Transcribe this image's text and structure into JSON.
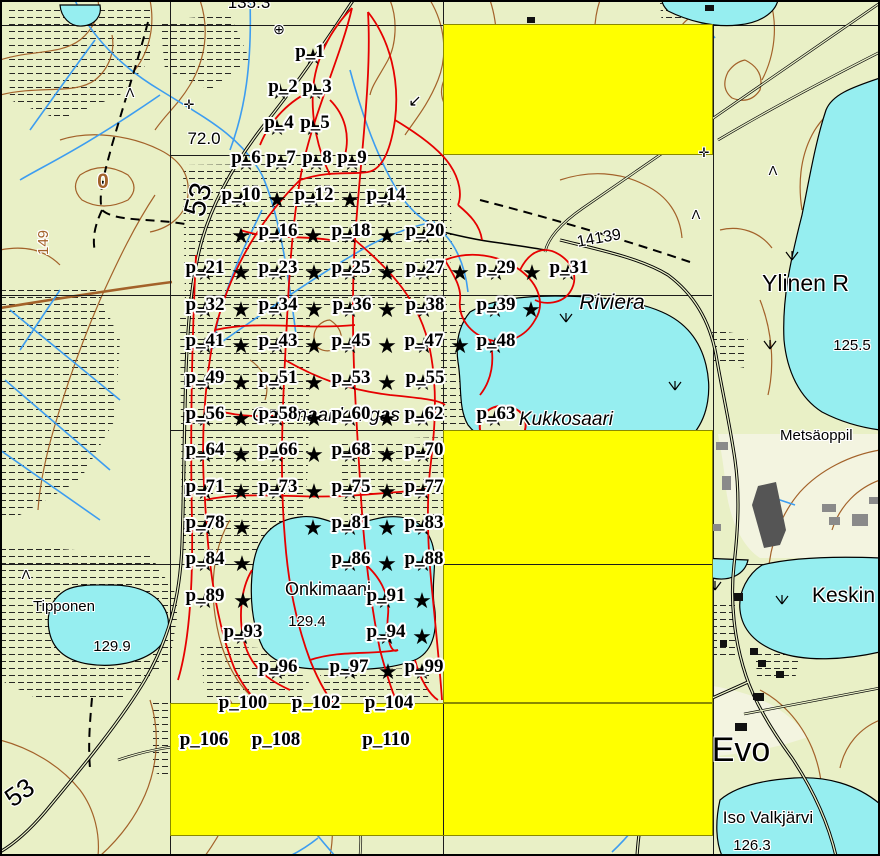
{
  "app": {
    "type": "map-canvas",
    "description": "Topographic map with sampling design points and highlighted grid cells"
  },
  "colors": {
    "land": "#e9f0c6",
    "open_land": "#f3f4e0",
    "water": "#96eef0",
    "highlight_yellow": "#ffff00",
    "highlight_border": "#8a8a00",
    "trail_red": "#e60000",
    "contour_brown": "#a3622a",
    "stream_blue": "#3d9df0",
    "grid_black": "#1c1c1c",
    "star_black": "#000000",
    "label_halo": "#ffffff"
  },
  "symbols": {
    "star": "★",
    "benchmark": "⊕",
    "powerline_cross": "✛",
    "slope_arrow": "↙",
    "tree": "Λ"
  },
  "highlight_rects": [
    {
      "x": 443,
      "y": 24,
      "w": 270,
      "h": 131
    },
    {
      "x": 443,
      "y": 430,
      "w": 270,
      "h": 273
    },
    {
      "x": 170,
      "y": 703,
      "w": 543,
      "h": 133
    }
  ],
  "grid_over_segments": [
    {
      "x": 443,
      "y": 704,
      "w": 1,
      "h": 131
    },
    {
      "x": 444,
      "y": 564,
      "w": 268,
      "h": 1
    }
  ],
  "sample_points": {
    "labels": [
      {
        "id": "p_1",
        "x": 310,
        "y": 42
      },
      {
        "id": "p_2",
        "x": 283,
        "y": 77
      },
      {
        "id": "p_3",
        "x": 317,
        "y": 77
      },
      {
        "id": "p_4",
        "x": 279,
        "y": 113
      },
      {
        "id": "p_5",
        "x": 315,
        "y": 113
      },
      {
        "id": "p_6",
        "x": 246,
        "y": 148
      },
      {
        "id": "p_7",
        "x": 281,
        "y": 148
      },
      {
        "id": "p_8",
        "x": 317,
        "y": 148
      },
      {
        "id": "p_9",
        "x": 352,
        "y": 148
      },
      {
        "id": "p_10",
        "x": 241,
        "y": 185
      },
      {
        "id": "p_12",
        "x": 314,
        "y": 185
      },
      {
        "id": "p_14",
        "x": 386,
        "y": 185
      },
      {
        "id": "p_16",
        "x": 278,
        "y": 221
      },
      {
        "id": "p_18",
        "x": 351,
        "y": 221
      },
      {
        "id": "p_20",
        "x": 425,
        "y": 221
      },
      {
        "id": "p_21",
        "x": 205,
        "y": 258
      },
      {
        "id": "p_23",
        "x": 278,
        "y": 258
      },
      {
        "id": "p_25",
        "x": 351,
        "y": 258
      },
      {
        "id": "p_27",
        "x": 425,
        "y": 258
      },
      {
        "id": "p_29",
        "x": 496,
        "y": 258
      },
      {
        "id": "p_31",
        "x": 569,
        "y": 258
      },
      {
        "id": "p_32",
        "x": 205,
        "y": 295
      },
      {
        "id": "p_34",
        "x": 278,
        "y": 295
      },
      {
        "id": "p_36",
        "x": 352,
        "y": 295
      },
      {
        "id": "p_38",
        "x": 425,
        "y": 295
      },
      {
        "id": "p_39",
        "x": 496,
        "y": 295
      },
      {
        "id": "p_41",
        "x": 205,
        "y": 331
      },
      {
        "id": "p_43",
        "x": 278,
        "y": 331
      },
      {
        "id": "p_45",
        "x": 351,
        "y": 331
      },
      {
        "id": "p_47",
        "x": 424,
        "y": 331
      },
      {
        "id": "p_48",
        "x": 496,
        "y": 331
      },
      {
        "id": "p_49",
        "x": 205,
        "y": 368
      },
      {
        "id": "p_51",
        "x": 278,
        "y": 368
      },
      {
        "id": "p_53",
        "x": 351,
        "y": 368
      },
      {
        "id": "p_55",
        "x": 425,
        "y": 368
      },
      {
        "id": "p_56",
        "x": 205,
        "y": 404
      },
      {
        "id": "p_58",
        "x": 278,
        "y": 404
      },
      {
        "id": "p_60",
        "x": 351,
        "y": 404
      },
      {
        "id": "p_62",
        "x": 424,
        "y": 404
      },
      {
        "id": "p_63",
        "x": 496,
        "y": 404
      },
      {
        "id": "p_64",
        "x": 205,
        "y": 440
      },
      {
        "id": "p_66",
        "x": 278,
        "y": 440
      },
      {
        "id": "p_68",
        "x": 351,
        "y": 440
      },
      {
        "id": "p_70",
        "x": 424,
        "y": 440
      },
      {
        "id": "p_71",
        "x": 205,
        "y": 477
      },
      {
        "id": "p_73",
        "x": 278,
        "y": 477
      },
      {
        "id": "p_75",
        "x": 351,
        "y": 477
      },
      {
        "id": "p_77",
        "x": 424,
        "y": 477
      },
      {
        "id": "p_78",
        "x": 205,
        "y": 513
      },
      {
        "id": "p_81",
        "x": 351,
        "y": 513
      },
      {
        "id": "p_83",
        "x": 424,
        "y": 513
      },
      {
        "id": "p_84",
        "x": 205,
        "y": 549
      },
      {
        "id": "p_86",
        "x": 351,
        "y": 549
      },
      {
        "id": "p_88",
        "x": 424,
        "y": 549
      },
      {
        "id": "p_89",
        "x": 205,
        "y": 586
      },
      {
        "id": "p_91",
        "x": 386,
        "y": 586
      },
      {
        "id": "p_93",
        "x": 243,
        "y": 622
      },
      {
        "id": "p_94",
        "x": 386,
        "y": 622
      },
      {
        "id": "p_96",
        "x": 278,
        "y": 657
      },
      {
        "id": "p_97",
        "x": 349,
        "y": 657
      },
      {
        "id": "p_99",
        "x": 424,
        "y": 657
      },
      {
        "id": "p_100",
        "x": 243,
        "y": 693
      },
      {
        "id": "p_102",
        "x": 316,
        "y": 693
      },
      {
        "id": "p_104",
        "x": 389,
        "y": 693
      },
      {
        "id": "p_106",
        "x": 204,
        "y": 730
      },
      {
        "id": "p_108",
        "x": 276,
        "y": 730
      },
      {
        "id": "p_110",
        "x": 386,
        "y": 730
      }
    ],
    "stars": [
      [
        313,
        58
      ],
      [
        280,
        93
      ],
      [
        315,
        93
      ],
      [
        277,
        129
      ],
      [
        313,
        129
      ],
      [
        246,
        164
      ],
      [
        281,
        164
      ],
      [
        316,
        164
      ],
      [
        352,
        164
      ],
      [
        241,
        201
      ],
      [
        277,
        201
      ],
      [
        313,
        201
      ],
      [
        350,
        201
      ],
      [
        386,
        201
      ],
      [
        241,
        237
      ],
      [
        277,
        237
      ],
      [
        313,
        237
      ],
      [
        350,
        237
      ],
      [
        387,
        237
      ],
      [
        424,
        237
      ],
      [
        205,
        274
      ],
      [
        241,
        274
      ],
      [
        277,
        274
      ],
      [
        314,
        274
      ],
      [
        350,
        274
      ],
      [
        387,
        274
      ],
      [
        424,
        274
      ],
      [
        460,
        274
      ],
      [
        496,
        274
      ],
      [
        532,
        274
      ],
      [
        568,
        274
      ],
      [
        205,
        311
      ],
      [
        241,
        311
      ],
      [
        277,
        311
      ],
      [
        314,
        311
      ],
      [
        350,
        311
      ],
      [
        387,
        311
      ],
      [
        424,
        311
      ],
      [
        495,
        311
      ],
      [
        531,
        311
      ],
      [
        205,
        347
      ],
      [
        241,
        347
      ],
      [
        277,
        347
      ],
      [
        314,
        347
      ],
      [
        350,
        347
      ],
      [
        387,
        347
      ],
      [
        424,
        347
      ],
      [
        460,
        347
      ],
      [
        495,
        347
      ],
      [
        205,
        384
      ],
      [
        241,
        384
      ],
      [
        277,
        384
      ],
      [
        314,
        384
      ],
      [
        350,
        384
      ],
      [
        387,
        384
      ],
      [
        423,
        384
      ],
      [
        205,
        420
      ],
      [
        241,
        420
      ],
      [
        277,
        420
      ],
      [
        314,
        420
      ],
      [
        350,
        420
      ],
      [
        387,
        420
      ],
      [
        423,
        420
      ],
      [
        495,
        420
      ],
      [
        205,
        456
      ],
      [
        241,
        456
      ],
      [
        277,
        456
      ],
      [
        314,
        456
      ],
      [
        350,
        456
      ],
      [
        387,
        456
      ],
      [
        423,
        456
      ],
      [
        205,
        493
      ],
      [
        241,
        493
      ],
      [
        277,
        493
      ],
      [
        314,
        493
      ],
      [
        350,
        493
      ],
      [
        387,
        493
      ],
      [
        423,
        493
      ],
      [
        205,
        529
      ],
      [
        242,
        529
      ],
      [
        313,
        529
      ],
      [
        350,
        529
      ],
      [
        387,
        529
      ],
      [
        423,
        529
      ],
      [
        205,
        565
      ],
      [
        242,
        565
      ],
      [
        350,
        565
      ],
      [
        387,
        565
      ],
      [
        423,
        565
      ],
      [
        205,
        602
      ],
      [
        243,
        602
      ],
      [
        385,
        602
      ],
      [
        422,
        602
      ],
      [
        242,
        638
      ],
      [
        387,
        638
      ],
      [
        422,
        638
      ],
      [
        277,
        673
      ],
      [
        350,
        673
      ],
      [
        388,
        673
      ],
      [
        422,
        673
      ]
    ]
  },
  "map_labels": [
    {
      "text": "135.3",
      "x": 249,
      "y": -6,
      "size": 17,
      "name": "spot-height-135-3"
    },
    {
      "text": "72.0",
      "x": 204,
      "y": 130,
      "size": 17,
      "name": "spot-height-72-0"
    },
    {
      "text": "0",
      "x": 103,
      "y": 171,
      "size": 21,
      "color": "#a3622a",
      "bold": true,
      "name": "contour-number-0"
    },
    {
      "text": "53",
      "x": 180,
      "y": 212,
      "size": 30,
      "rotate": -75,
      "anchor": "left",
      "name": "compartment-number-53"
    },
    {
      "text": "149",
      "x": 36,
      "y": 255,
      "size": 15,
      "color": "#a3622a",
      "rotate": -90,
      "anchor": "left",
      "name": "contour-number-149"
    },
    {
      "text": "14139",
      "x": 598,
      "y": 235,
      "size": 16,
      "rotate": -10,
      "name": "road-number-14139"
    },
    {
      "text": "Riviera",
      "x": 612,
      "y": 292,
      "size": 21,
      "italic": true,
      "name": "lake-name-riviera"
    },
    {
      "text": "Ylinen R",
      "x": 762,
      "y": 272,
      "size": 23,
      "anchor": "left",
      "name": "lake-name-ylinen"
    },
    {
      "text": "125.5",
      "x": 852,
      "y": 338,
      "size": 15,
      "name": "water-level-125-5"
    },
    {
      "text": "Kukkosaari",
      "x": 566,
      "y": 410,
      "size": 19,
      "italic": true,
      "name": "island-name-kukkosaari"
    },
    {
      "text": "Onkimaankangas",
      "x": 326,
      "y": 406,
      "size": 19,
      "italic": true,
      "name": "area-name-onkimaankangas"
    },
    {
      "text": "Metsäoppil",
      "x": 780,
      "y": 428,
      "size": 15,
      "anchor": "left",
      "name": "place-name-metsaoppilaitos"
    },
    {
      "text": "Onkimaanj",
      "x": 285,
      "y": 580,
      "size": 18,
      "anchor": "left",
      "name": "lake-name-onkimaanjarvi"
    },
    {
      "text": "129.4",
      "x": 307,
      "y": 614,
      "size": 15,
      "name": "water-level-129-4"
    },
    {
      "text": "Tipponen",
      "x": 64,
      "y": 599,
      "size": 15,
      "name": "pond-name-tipponen"
    },
    {
      "text": "129.9",
      "x": 112,
      "y": 639,
      "size": 15,
      "name": "water-level-129-9"
    },
    {
      "text": "Keskin",
      "x": 812,
      "y": 585,
      "size": 21,
      "anchor": "left",
      "name": "lake-name-keskinen"
    },
    {
      "text": "Evo",
      "x": 741,
      "y": 733,
      "size": 34,
      "name": "place-name-evo"
    },
    {
      "text": "Iso Valkjärvi",
      "x": 768,
      "y": 809,
      "size": 17,
      "name": "lake-name-iso-valkjarvi"
    },
    {
      "text": "126.3",
      "x": 752,
      "y": 838,
      "size": 15,
      "name": "water-level-126-3"
    },
    {
      "text": "53",
      "x": 0,
      "y": 790,
      "size": 26,
      "rotate": -35,
      "anchor": "left",
      "name": "road-number-53"
    },
    {
      "text": "⊕",
      "x": 279,
      "y": 22,
      "size": 14,
      "name": "benchmark-icon"
    },
    {
      "text": "✛",
      "x": 189,
      "y": 98,
      "size": 13,
      "name": "powerline-cross-icon"
    },
    {
      "text": "✛",
      "x": 704,
      "y": 146,
      "size": 13,
      "name": "powerline-cross-icon"
    },
    {
      "text": "↙",
      "x": 415,
      "y": 94,
      "size": 16,
      "name": "slope-arrow-icon"
    },
    {
      "text": "Λ",
      "x": 130,
      "y": 86,
      "size": 13,
      "name": "tree-symbol-icon"
    },
    {
      "text": "Λ",
      "x": 696,
      "y": 208,
      "size": 13,
      "name": "tree-symbol-icon"
    },
    {
      "text": "Λ",
      "x": 26,
      "y": 568,
      "size": 13,
      "name": "tree-symbol-icon"
    },
    {
      "text": "Λ",
      "x": 773,
      "y": 164,
      "size": 13,
      "name": "tree-symbol-icon"
    }
  ]
}
